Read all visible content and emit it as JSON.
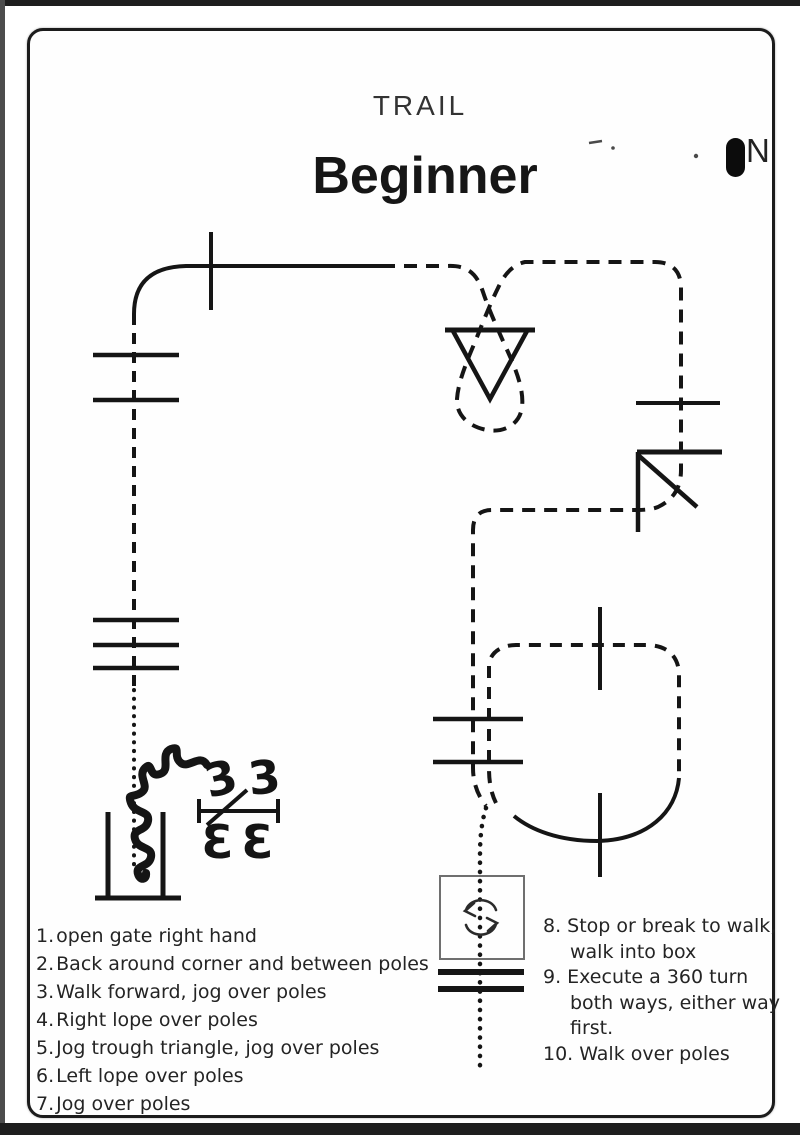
{
  "header": {
    "category": "TRAIL",
    "title": "Beginner"
  },
  "compass": {
    "label": "N"
  },
  "instructions_left": [
    {
      "num": "1.",
      "text": "open gate right hand"
    },
    {
      "num": "2.",
      "text": "Back around corner and between poles"
    },
    {
      "num": "3.",
      "text": "Walk forward, jog over poles"
    },
    {
      "num": "4.",
      "text": "Right lope over poles"
    },
    {
      "num": "5.",
      "text": "Jog trough triangle, jog over poles"
    },
    {
      "num": "6.",
      "text": "Left lope over poles"
    },
    {
      "num": "7.",
      "text": "Jog over poles"
    }
  ],
  "instructions_right": [
    {
      "num": "8.",
      "lines": [
        "Stop or break to walk,",
        "walk into box"
      ]
    },
    {
      "num": "9.",
      "lines": [
        "Execute a 360 turn",
        "both ways, either way",
        "first."
      ]
    },
    {
      "num": "10.",
      "lines": [
        "Walk over poles"
      ]
    }
  ],
  "gate": {
    "coil_glyph": "3"
  },
  "colors": {
    "ink": "#161616",
    "box_border": "#6f6f6f",
    "page_bg": "#ffffff",
    "frame": "#1c1c1c"
  }
}
